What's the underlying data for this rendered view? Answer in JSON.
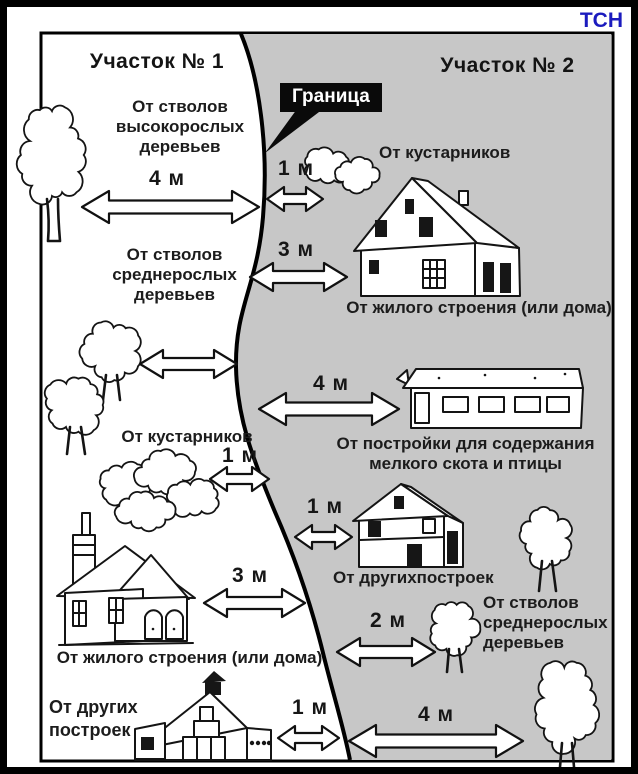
{
  "brand": "ТСН",
  "plots": {
    "plot1": "Участок № 1",
    "plot2": "Участок № 2"
  },
  "boundary": {
    "label": "Граница"
  },
  "left": {
    "tall_trees": {
      "label": "От стволов\nвысокорослых\nдеревьев",
      "distance": "4 м"
    },
    "medium_trees": {
      "label": "От стволов\nсреднерослых\nдеревьев"
    },
    "shrubs": {
      "label": "От кустарников",
      "distance": "1 м"
    },
    "house": {
      "label": "От жилого строения (или дома)",
      "distance": "3 м"
    },
    "other_buildings": {
      "label": "От других\nпостроек",
      "distance": "1 м"
    }
  },
  "right": {
    "shrubs": {
      "label": "От кустарников",
      "distance": "1 м"
    },
    "house": {
      "label": "От жилого строения (или дома)",
      "distance": "3 м"
    },
    "livestock_building": {
      "label": "От постройки для содержания\nмелкого скота и птицы",
      "distance": "4 м"
    },
    "other_buildings": {
      "label": "От другихпостроек",
      "distance": "1 м"
    },
    "medium_trees": {
      "label": "От стволов\nсреднерослых\nдеревьев",
      "distance": "2 м"
    },
    "tall_tree": {
      "distance": "4 м"
    }
  },
  "colors": {
    "plot2_bg": "#c7c7c7",
    "brand_blue": "#1b1bbe",
    "ink": "#111111"
  }
}
